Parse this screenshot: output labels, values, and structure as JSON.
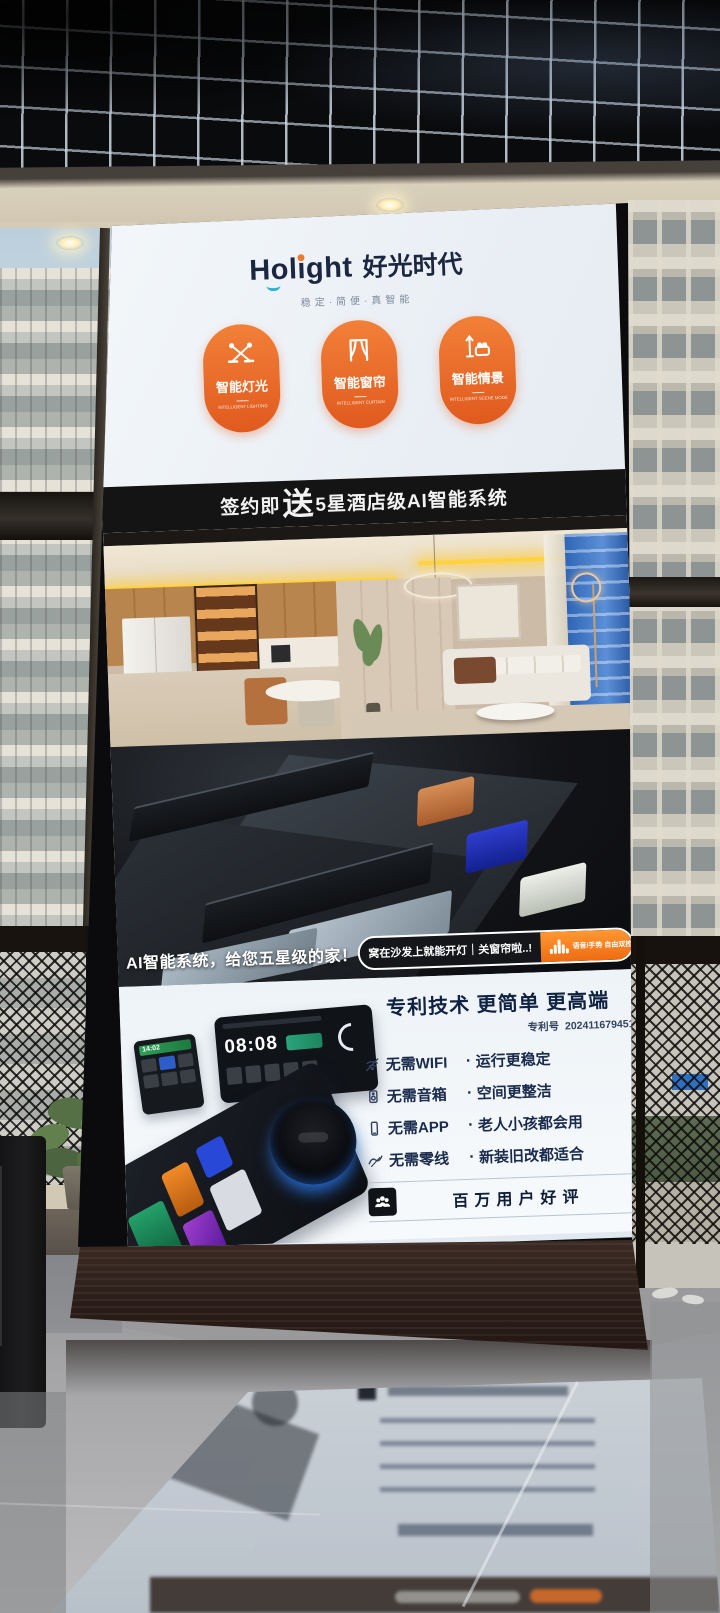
{
  "screen": {
    "brand": {
      "logo_latin": "Holight",
      "logo_cn": "好光时代",
      "tagline": "稳定·简便·真智能"
    },
    "badges": [
      {
        "label": "智能灯光",
        "sublabel": "INTELLIGENT LIGHTING",
        "icon": "pendant-lights-icon"
      },
      {
        "label": "智能窗帘",
        "sublabel": "INTELLIGENT CURTAIN",
        "icon": "curtain-icon"
      },
      {
        "label": "智能情景",
        "sublabel": "INTELLIGENT SCENE MODE",
        "icon": "scene-bed-lamp-icon"
      }
    ],
    "banner": {
      "prefix": "签约即",
      "highlight": "送",
      "suffix": "5星酒店级AI智能系统"
    },
    "promo": {
      "headline": "AI智能系统，给您五星级的家！",
      "speech_bubble": "窝在沙发上就能开灯｜关窗帘啦..!",
      "voice_tag": "语音/手势 自由双控"
    },
    "patent": {
      "title": "专利技术 更简单 更高端",
      "patent_no_label": "专利号",
      "patent_no": "202411679451"
    },
    "features_dot": "·",
    "features": [
      {
        "icon": "no-wifi-icon",
        "name": "无需WIFI",
        "benefit": "运行更稳定"
      },
      {
        "icon": "no-speaker-icon",
        "name": "无需音箱",
        "benefit": "空间更整洁"
      },
      {
        "icon": "no-app-icon",
        "name": "无需APP",
        "benefit": "老人小孩都会用"
      },
      {
        "icon": "no-neutral-wire-icon",
        "name": "无需零线",
        "benefit": "新装旧改都适合"
      }
    ],
    "reviews": {
      "label": "百万用户好评",
      "icon": "users-icon"
    },
    "panel_clocks": {
      "small": "14:02",
      "large": "08:08"
    },
    "colors": {
      "brand_orange": "#E8622A",
      "navy_text": "#0F2244",
      "banner_bg": "#141414",
      "screen_bg": "#EDF2F6",
      "pill_orange": "#EE6C12"
    }
  }
}
